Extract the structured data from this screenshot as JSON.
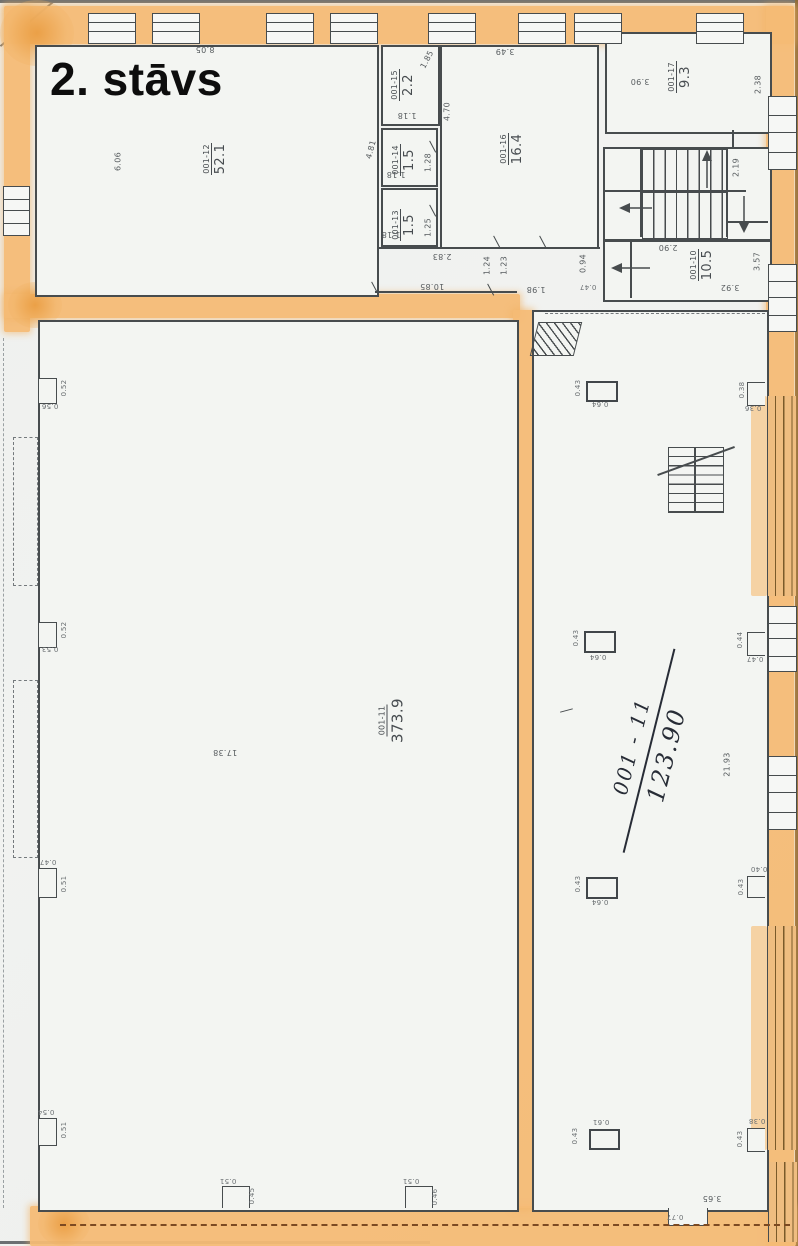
{
  "title": "2. stāvs",
  "rooms": {
    "r12": {
      "id": "001-12",
      "area": "52.1"
    },
    "r15": {
      "id": "001-15",
      "area": "2.2"
    },
    "r14": {
      "id": "001-14",
      "area": "1.5"
    },
    "r13": {
      "id": "001-13",
      "area": "1.5"
    },
    "r16": {
      "id": "001-16",
      "area": "16.4"
    },
    "r17": {
      "id": "001-17",
      "area": "9.3"
    },
    "r10": {
      "id": "001-10",
      "area": "10.5"
    },
    "r11": {
      "id": "001-11",
      "area": "373.9"
    }
  },
  "handwritten": {
    "room": "001 - 11",
    "area": "123.90"
  },
  "dims": {
    "top_width": "8.05",
    "r12_height": "6.06",
    "corridor_top": "10.85",
    "r15_door": "1.85",
    "r15_width": "1.18",
    "left_45": "4.81",
    "r16_left": "4.70",
    "r14_height": "1.28",
    "r14_width": "1.18",
    "r13_height": "1.25",
    "r13_width": "1.18",
    "r16_top": "3.49",
    "below_r13": "2.83",
    "door_a": "1.24",
    "door_b": "1.23",
    "pass_a": "0.94",
    "pass_b": "0.47",
    "door_c": "1.98",
    "r10_top": "2.90",
    "r10_bottom": "3.92",
    "r10_right": "3.57",
    "stair_width": "2.19",
    "r17_width": "3.90",
    "r17_right": "2.38",
    "hall_width": "17.38",
    "hall_right_height": "21.93",
    "bottom_right": "3.65",
    "bottom_notch": "0.77"
  },
  "left_niches": [
    {
      "a": "0.52",
      "b": "0.56"
    },
    {
      "a": "0.52",
      "b": "0.53"
    },
    {
      "a": "0.47",
      "b": "0.51"
    },
    {
      "a": "0.54",
      "b": "0.51"
    }
  ],
  "columns": [
    {
      "h": "0.43",
      "w": "0.64"
    },
    {
      "h": "0.43",
      "w": "0.64"
    },
    {
      "h": "0.43",
      "w": "0.64"
    },
    {
      "h": "0.43",
      "w": "0.61"
    }
  ],
  "right_niches": [
    {
      "a": "0.38",
      "b": "0.36"
    },
    {
      "a": "0.44",
      "b": "0.47"
    },
    {
      "a": "0.40",
      "b": "0.43"
    },
    {
      "a": "0.38",
      "b": "0.43"
    }
  ],
  "bottom_piers": [
    {
      "a": "0.51",
      "b": "0.45"
    },
    {
      "a": "0.51",
      "b": "0.46"
    }
  ]
}
